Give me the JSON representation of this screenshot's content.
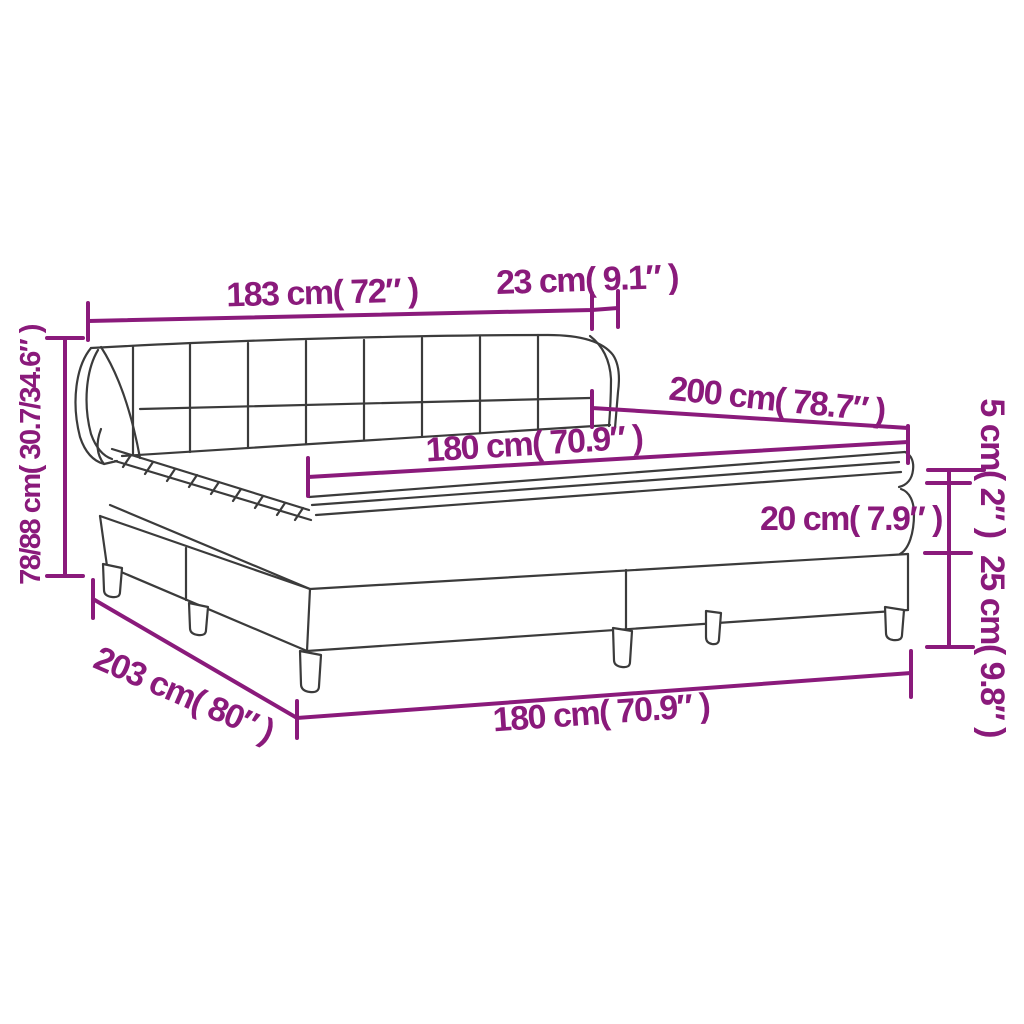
{
  "diagram": {
    "type": "product-dimension-diagram",
    "subject": "box spring bed with headboard, mattress and topper",
    "colors": {
      "dimension_lines": "#8A1A7B",
      "drawing_outline": "#3B3B3B",
      "background": "#FFFFFF"
    },
    "labels": {
      "headboard_width": "183 cm( 72″ )",
      "headboard_depth": "23 cm( 9.1″ )",
      "bed_length": "200 cm( 78.7″ )",
      "mattress_width": "180 cm( 70.9″ )",
      "topper_height": "5 cm( 2″ )",
      "mattress_height": "20 cm( 7.9″ )",
      "base_height": "25 cm( 9.8″ )",
      "total_height": "78/88 cm( 30.7/34.6″ )",
      "base_length": "203 cm( 80″ )",
      "base_width": "180 cm( 70.9″ )"
    }
  }
}
